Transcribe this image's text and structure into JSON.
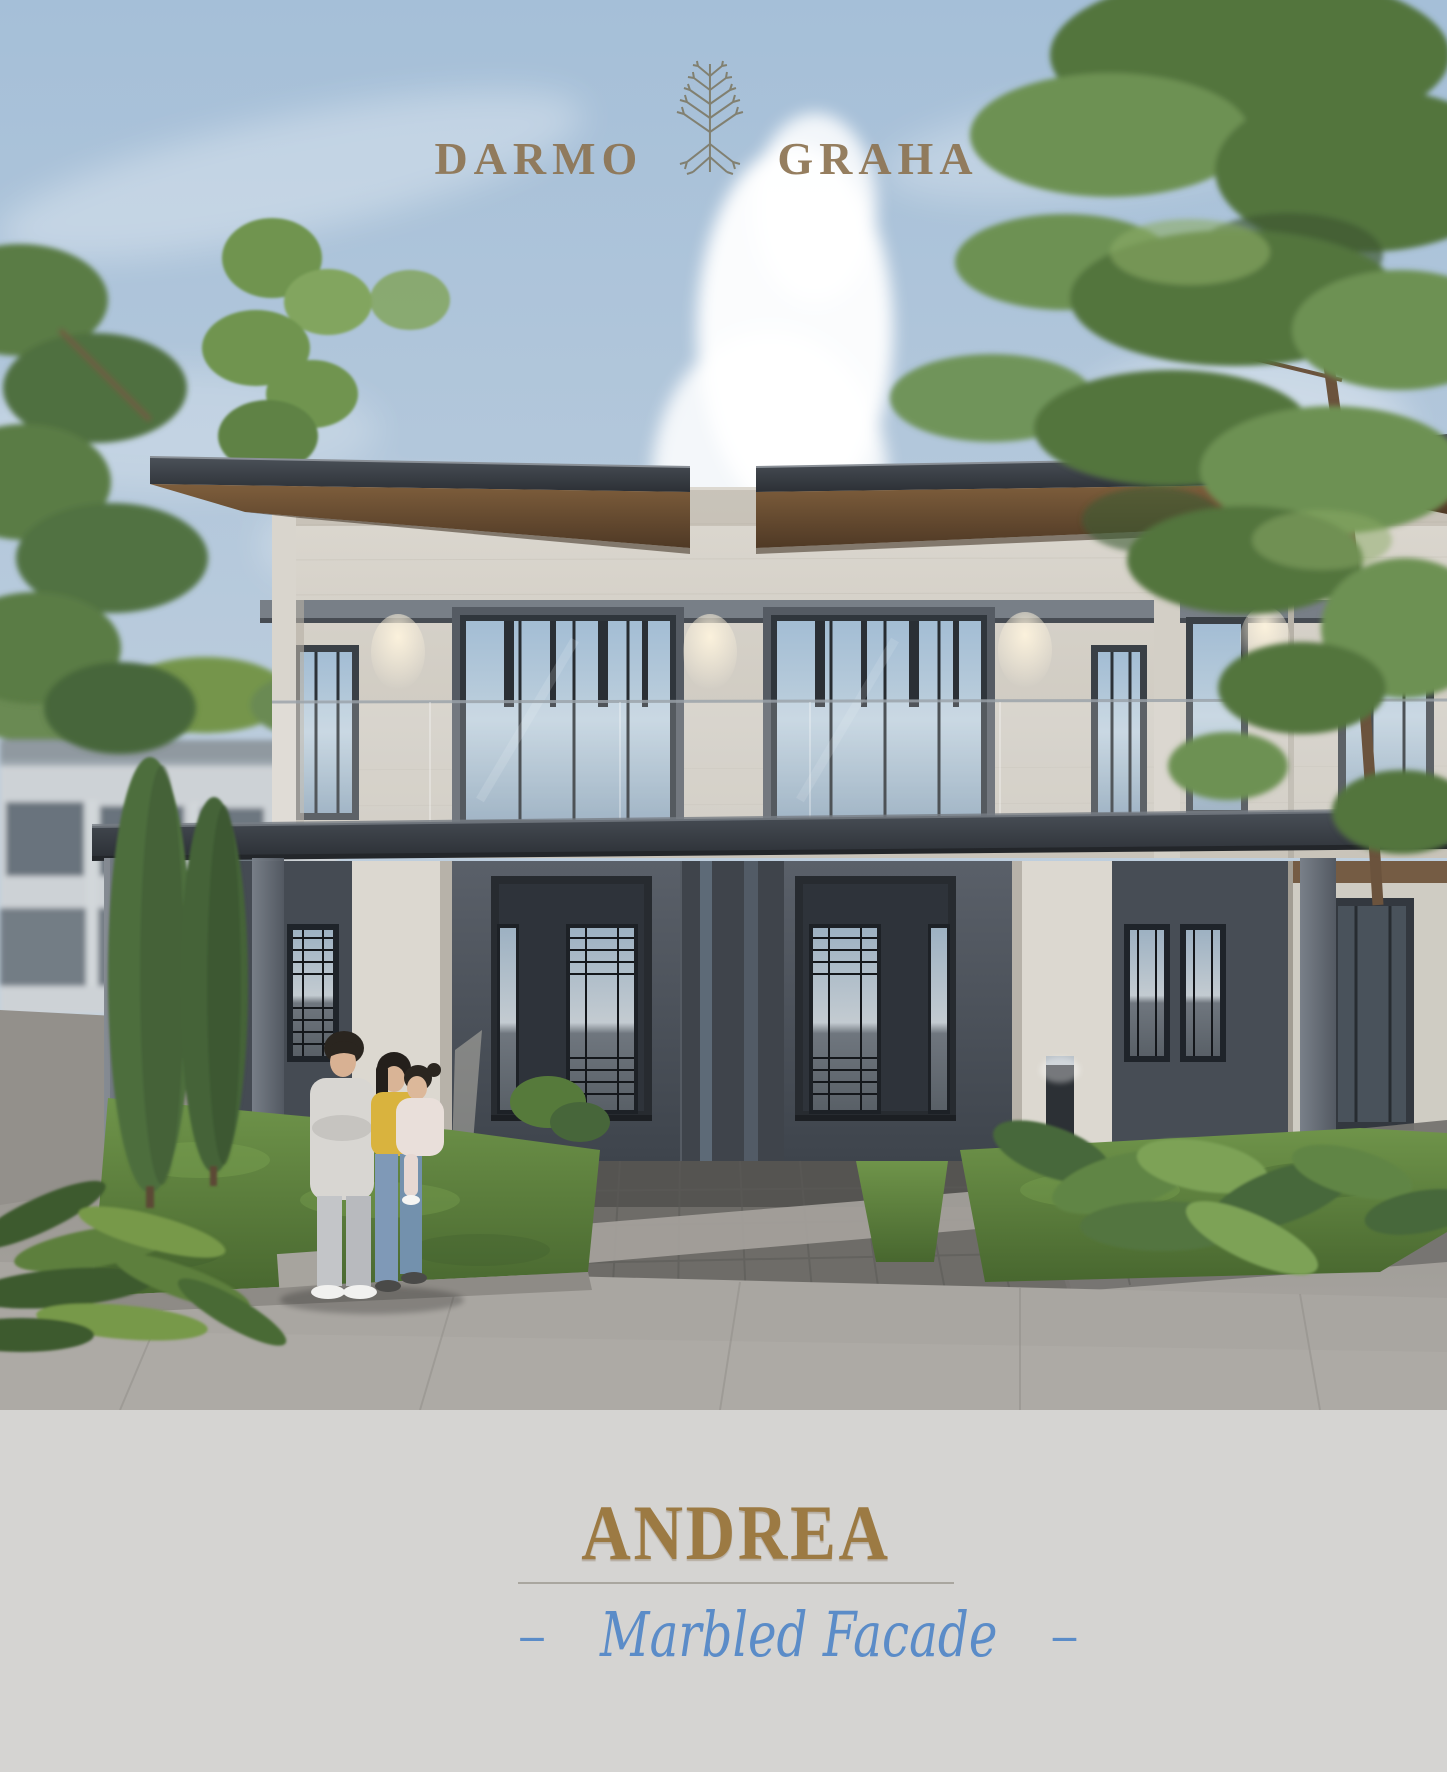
{
  "brand": {
    "word_left": "DARMO",
    "word_right": "GRAHA",
    "logo_icon": "pine-tree-icon"
  },
  "footer": {
    "title": "ANDREA",
    "subtitle": "Marbled Facade",
    "subtitle_dash_left": "–",
    "subtitle_dash_right": "–"
  },
  "colors": {
    "brand_gold": "#8d7553",
    "title_gold": "#9c7a43",
    "subtitle_blue": "#5b8cc8",
    "divider_gray": "#a9a69f",
    "footer_background": "#d5d4d2",
    "sky_blue": "#a5bfd8",
    "cloud_white": "#ffffff",
    "roof_fascia_dark": "#2c3036",
    "roof_soffit_brown": "#6b4f33",
    "marble_facade": "#d5d1c8",
    "dark_wall_gray": "#474d55",
    "window_glass_blue": "#a3bdd4",
    "wood_soffit_brown": "#7a5a39",
    "grass_green": "#5e8040",
    "pavement_gray": "#a29f9a",
    "paver_dark_gray": "#6e6c68"
  }
}
